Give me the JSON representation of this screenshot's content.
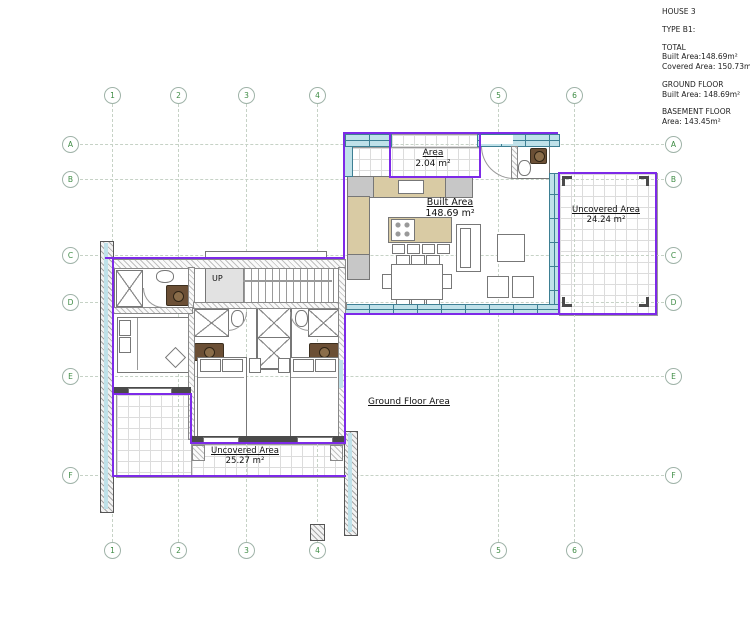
{
  "title_block": {
    "project": "HOUSE 3",
    "type": "TYPE B1:",
    "total_heading": "TOTAL",
    "total_built": "Built Area:148.69m²",
    "total_covered": "Covered Area: 150.73m²",
    "ground_heading": "GROUND FLOOR",
    "ground_built": "Built Area: 148.69m²",
    "basement_heading": "BASEMENT FLOOR",
    "basement_area": "Area: 143.45m²"
  },
  "grid": {
    "columns": [
      "1",
      "2",
      "3",
      "4",
      "5",
      "6"
    ],
    "rows": [
      "A",
      "B",
      "C",
      "D",
      "E",
      "F"
    ]
  },
  "plan_labels": {
    "entrance_area": {
      "title": "Area",
      "value": "2.04 m²"
    },
    "built_area": {
      "title": "Built Area",
      "value": "148.69 m²"
    },
    "uncovered_area_right": {
      "title": "Uncovered Area",
      "value": "24.24 m²"
    },
    "uncovered_area_left": {
      "title": "Uncovered Area",
      "value": "25.27 m²"
    },
    "ground_floor_area": "Ground Floor Area",
    "stairs": "UP"
  },
  "colors": {
    "boundary_purple": "#7D2AE8",
    "wall_fill_cyan": "#BFE1E9",
    "wall_edge_teal": "#3D7F93",
    "counter_tan": "#D9CBA4",
    "grid_label_green": "#3E8C44",
    "vanity_brown": "#6B4F35",
    "tile_line_gray": "#DCDCDC"
  }
}
